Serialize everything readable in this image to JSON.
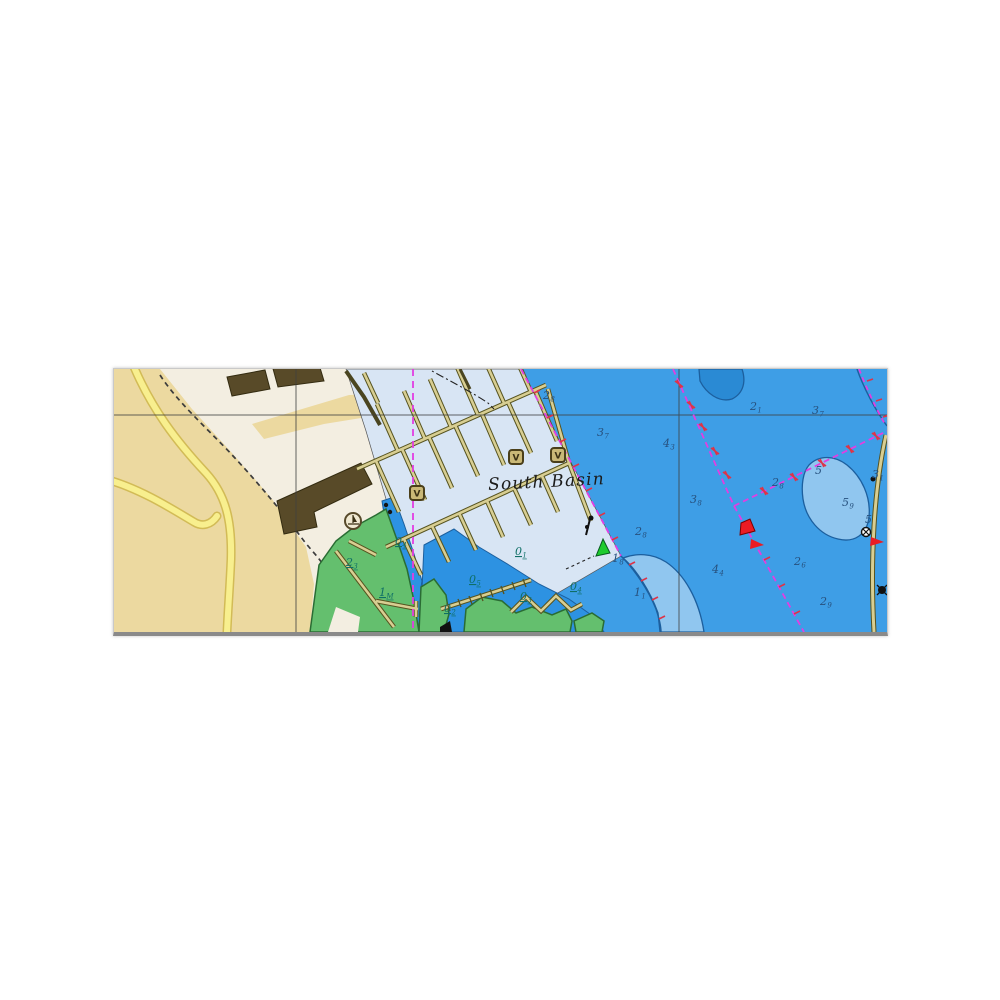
{
  "page": {
    "background": "#ffffff"
  },
  "chart": {
    "place_label": "South Basin",
    "badge_letter": "V",
    "colors": {
      "deep_water": "#3e9ee6",
      "mid_water": "#2d92e2",
      "shoal_water": "#90c6ef",
      "marina_water": "#d8e5f4",
      "land_cream": "#f3eee1",
      "land_tan": "#ecd9a0",
      "road_fill": "#f8ef8e",
      "road_casing": "#d2bb56",
      "green_area": "#64bf6e",
      "building": "#584a28",
      "dock_fill": "#d8ce92",
      "dock_outline": "#56531f",
      "boundary_magenta": "#e23ee2",
      "mark_red": "#dd3448",
      "buoy_red": "#ea1c24",
      "buoy_green": "#1ecb2e",
      "contour_blue": "#1c5f9e",
      "sounding_navy": "#27517e",
      "sounding_teal": "#0f6f66"
    },
    "badges": [
      {
        "x": 402,
        "y": 88
      },
      {
        "x": 444,
        "y": 86
      },
      {
        "x": 303,
        "y": 124
      }
    ],
    "soundings": [
      {
        "d": "2",
        "s": "8",
        "x": 429,
        "y": 30,
        "type": "navy"
      },
      {
        "d": "3",
        "s": "7",
        "x": 483,
        "y": 67,
        "type": "navy"
      },
      {
        "d": "4",
        "s": "3",
        "x": 549,
        "y": 78,
        "type": "navy"
      },
      {
        "d": "2",
        "s": "1",
        "x": 636,
        "y": 41,
        "type": "navy"
      },
      {
        "d": "3",
        "s": "7",
        "x": 698,
        "y": 45,
        "type": "navy"
      },
      {
        "d": "3",
        "s": "8",
        "x": 576,
        "y": 134,
        "type": "navy"
      },
      {
        "d": "2",
        "s": "8",
        "x": 658,
        "y": 117,
        "type": "navy"
      },
      {
        "d": "5",
        "s": "",
        "x": 701,
        "y": 105,
        "type": "navy"
      },
      {
        "d": "3",
        "s": "1",
        "x": 758,
        "y": 109,
        "type": "navy"
      },
      {
        "d": "5",
        "s": "9",
        "x": 728,
        "y": 137,
        "type": "navy"
      },
      {
        "d": "5",
        "s": "",
        "x": 751,
        "y": 154,
        "type": "navy"
      },
      {
        "d": "2",
        "s": "8",
        "x": 521,
        "y": 166,
        "type": "navy"
      },
      {
        "d": "1",
        "s": "8",
        "x": 498,
        "y": 193,
        "type": "navy"
      },
      {
        "d": "2",
        "s": "6",
        "x": 680,
        "y": 196,
        "type": "navy"
      },
      {
        "d": "2",
        "s": "9",
        "x": 706,
        "y": 236,
        "type": "navy"
      },
      {
        "d": "4",
        "s": "4",
        "x": 598,
        "y": 204,
        "type": "navy"
      },
      {
        "d": "1",
        "s": "1",
        "x": 520,
        "y": 227,
        "type": "navy"
      },
      {
        "d": "0",
        "s": "4",
        "x": 281,
        "y": 176,
        "type": "dry"
      },
      {
        "d": "2",
        "s": "3",
        "x": 232,
        "y": 197,
        "type": "dry"
      },
      {
        "d": "1",
        "s": "M",
        "x": 265,
        "y": 227,
        "type": "dry"
      },
      {
        "d": "0",
        "s": "5",
        "x": 355,
        "y": 214,
        "type": "dry"
      },
      {
        "d": "0",
        "s": "1",
        "x": 401,
        "y": 186,
        "type": "dry"
      },
      {
        "d": "0",
        "s": "3",
        "x": 406,
        "y": 231,
        "type": "dry"
      },
      {
        "d": "0",
        "s": "4",
        "x": 456,
        "y": 221,
        "type": "dry"
      },
      {
        "d": "0",
        "s": "2",
        "x": 330,
        "y": 243,
        "type": "dry"
      }
    ]
  }
}
